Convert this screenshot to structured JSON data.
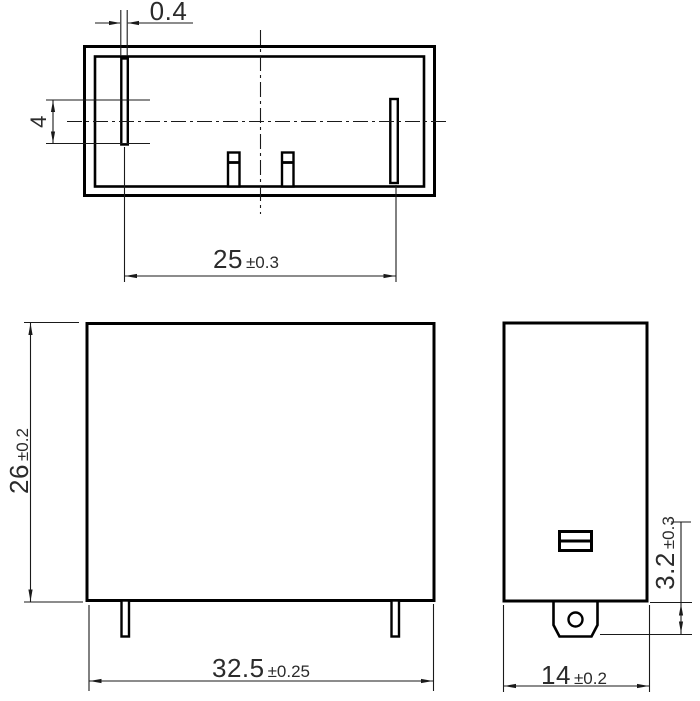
{
  "colors": {
    "background": "#ffffff",
    "line": "#000000",
    "dim_text": "#2b2b2b"
  },
  "dimensions": {
    "slot_width": {
      "value": "0.4",
      "tolerance": ""
    },
    "slot_offset": {
      "value": "4",
      "tolerance": ""
    },
    "pin_pitch": {
      "value": "25",
      "tolerance": "±0.3"
    },
    "body_height": {
      "value": "26",
      "tolerance": "±0.2"
    },
    "body_length": {
      "value": "32.5",
      "tolerance": "±0.25"
    },
    "body_width": {
      "value": "14",
      "tolerance": "±0.2"
    },
    "tab_length": {
      "value": "3.2",
      "tolerance": "±0.3"
    }
  }
}
